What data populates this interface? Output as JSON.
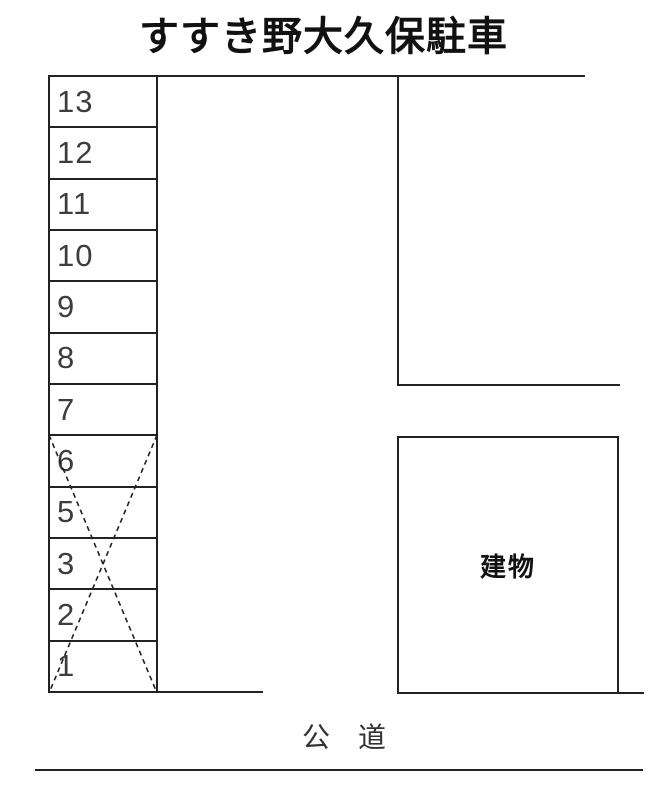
{
  "title": "すすき野大久保駐車",
  "parking_column": {
    "spaces": [
      {
        "number": "13",
        "crossed": false
      },
      {
        "number": "12",
        "crossed": false
      },
      {
        "number": "11",
        "crossed": false
      },
      {
        "number": "10",
        "crossed": false
      },
      {
        "number": "9",
        "crossed": false
      },
      {
        "number": "8",
        "crossed": false
      },
      {
        "number": "7",
        "crossed": false
      },
      {
        "number": "6",
        "crossed": true
      },
      {
        "number": "5",
        "crossed": true
      },
      {
        "number": "3",
        "crossed": true
      },
      {
        "number": "2",
        "crossed": true
      },
      {
        "number": "1",
        "crossed": true
      }
    ],
    "cross_mark": {
      "from_space": "6",
      "to_space": "1",
      "style": "dashed-x"
    }
  },
  "building": {
    "label": "建物"
  },
  "road": {
    "label": "公　道"
  },
  "colors": {
    "line": "#222222",
    "digit": "#3d3d3d",
    "text": "#111111",
    "background": "#ffffff"
  }
}
